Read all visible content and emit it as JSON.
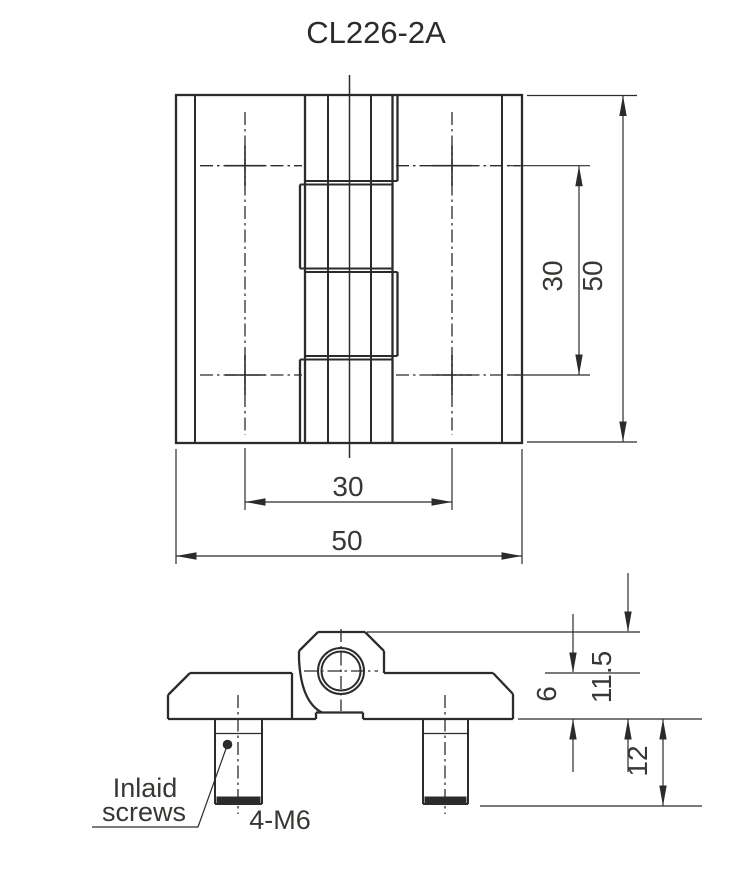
{
  "title": "CL226-2A",
  "dimensions": {
    "front_height": "50",
    "front_hole_spacing_y": "30",
    "front_hole_spacing_x": "30",
    "front_width": "50",
    "plate_thickness": "6",
    "knuckle_height": "11.5",
    "screw_length": "12"
  },
  "annotations": {
    "screw_note_line1": "Inlaid",
    "screw_note_line2": "screws",
    "screw_spec": "4-M6"
  },
  "colors": {
    "line": "#2d2b29",
    "background": "#ffffff"
  }
}
